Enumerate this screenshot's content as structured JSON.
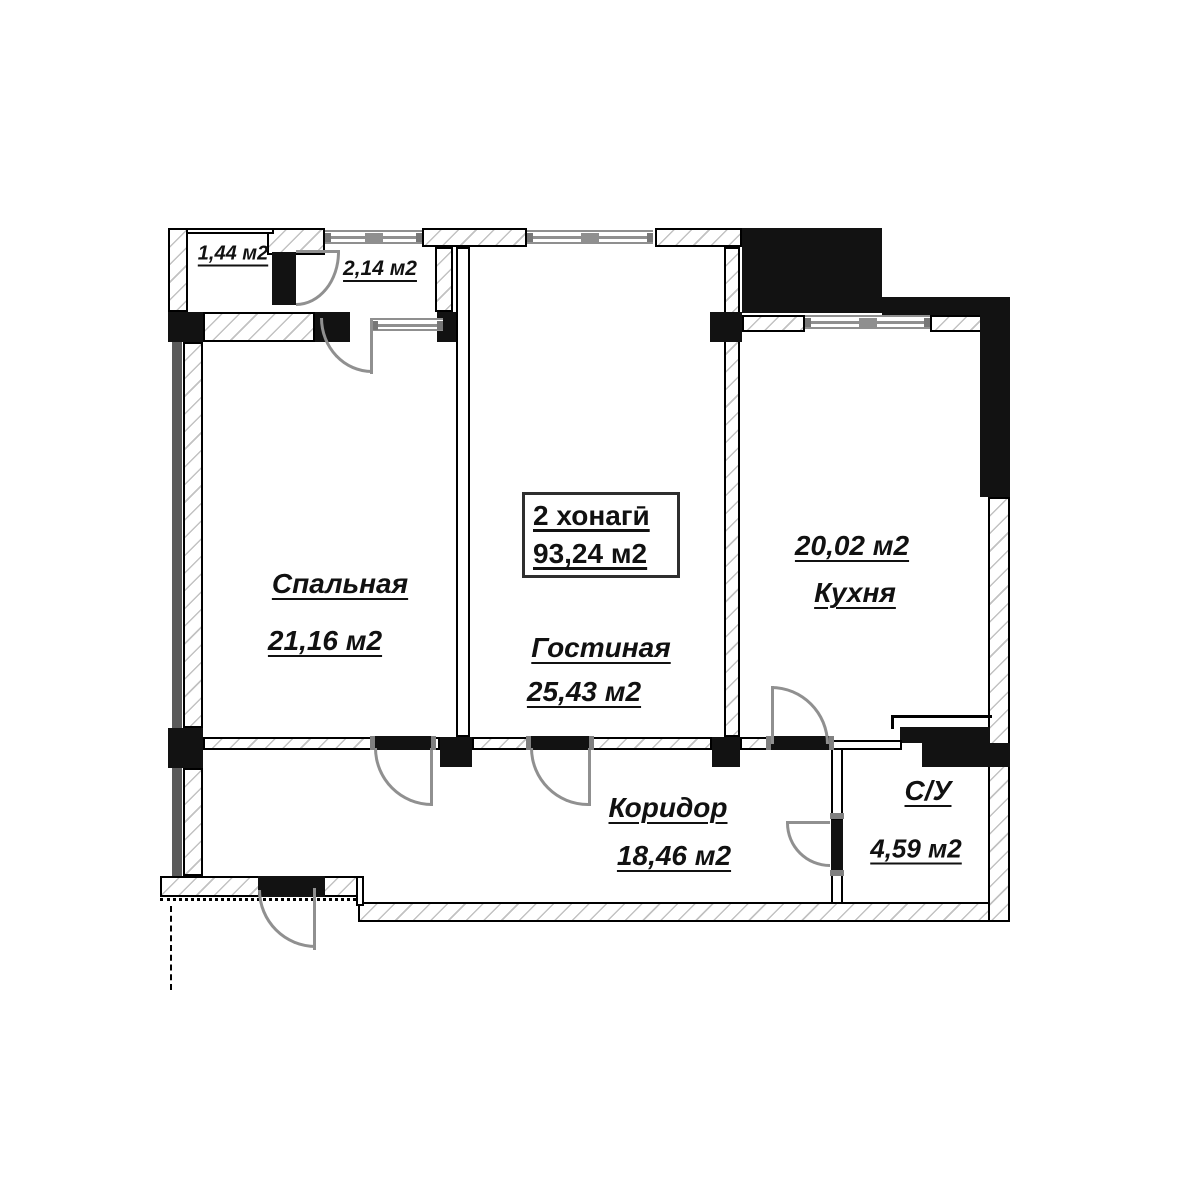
{
  "summary": {
    "rooms_count_line": "2 хонагӣ",
    "total_area_line": "93,24 м2"
  },
  "rooms": {
    "balcony_small": {
      "area": "1,44 м2"
    },
    "balcony": {
      "area": "2,14 м2"
    },
    "bedroom": {
      "name": "Спальная",
      "area": "21,16 м2"
    },
    "living_room": {
      "name": "Гостиная",
      "area": "25,43 м2"
    },
    "kitchen": {
      "area": "20,02 м2",
      "name": "Кухня"
    },
    "corridor": {
      "name": "Коридор",
      "area": "18,46 м2"
    },
    "bathroom": {
      "name": "С/У",
      "area": "4,59 м2"
    }
  },
  "colors": {
    "wall_black": "#121212",
    "hatch_line": "#c2c2c2",
    "fixture_gray": "#909090",
    "outer_strip_gray": "#5a5a5a"
  }
}
